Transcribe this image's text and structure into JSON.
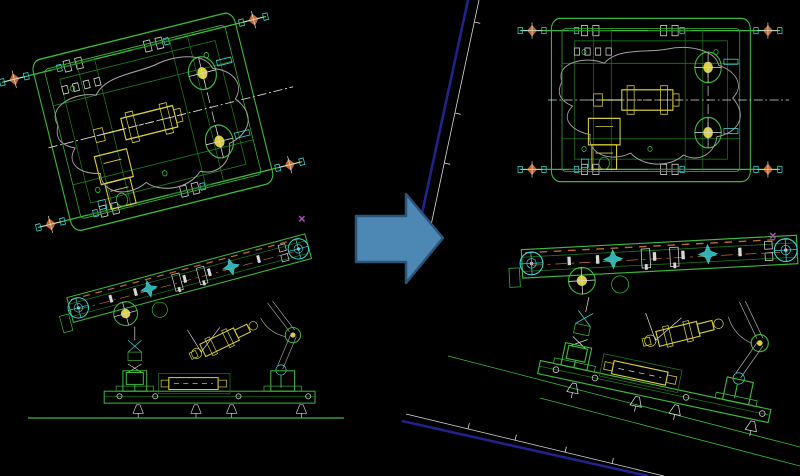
{
  "canvas": {
    "width": 800,
    "height": 476,
    "background": "#000000"
  },
  "colors": {
    "green": "#3db83d",
    "green2": "#1e7a1e",
    "yellow": "#d8cf3a",
    "cyan": "#3ecfcf",
    "white": "#d8d8d8",
    "blob": "#9f9f9f",
    "orange": "#bf6a2e",
    "magenta": "#a94fb4",
    "navy": "#22228c",
    "arrow_fill": "#4d87b3",
    "arrow_edge": "#2a5478"
  },
  "markers": {
    "point_glyph": "×"
  },
  "arrow": {
    "direction": "right"
  }
}
